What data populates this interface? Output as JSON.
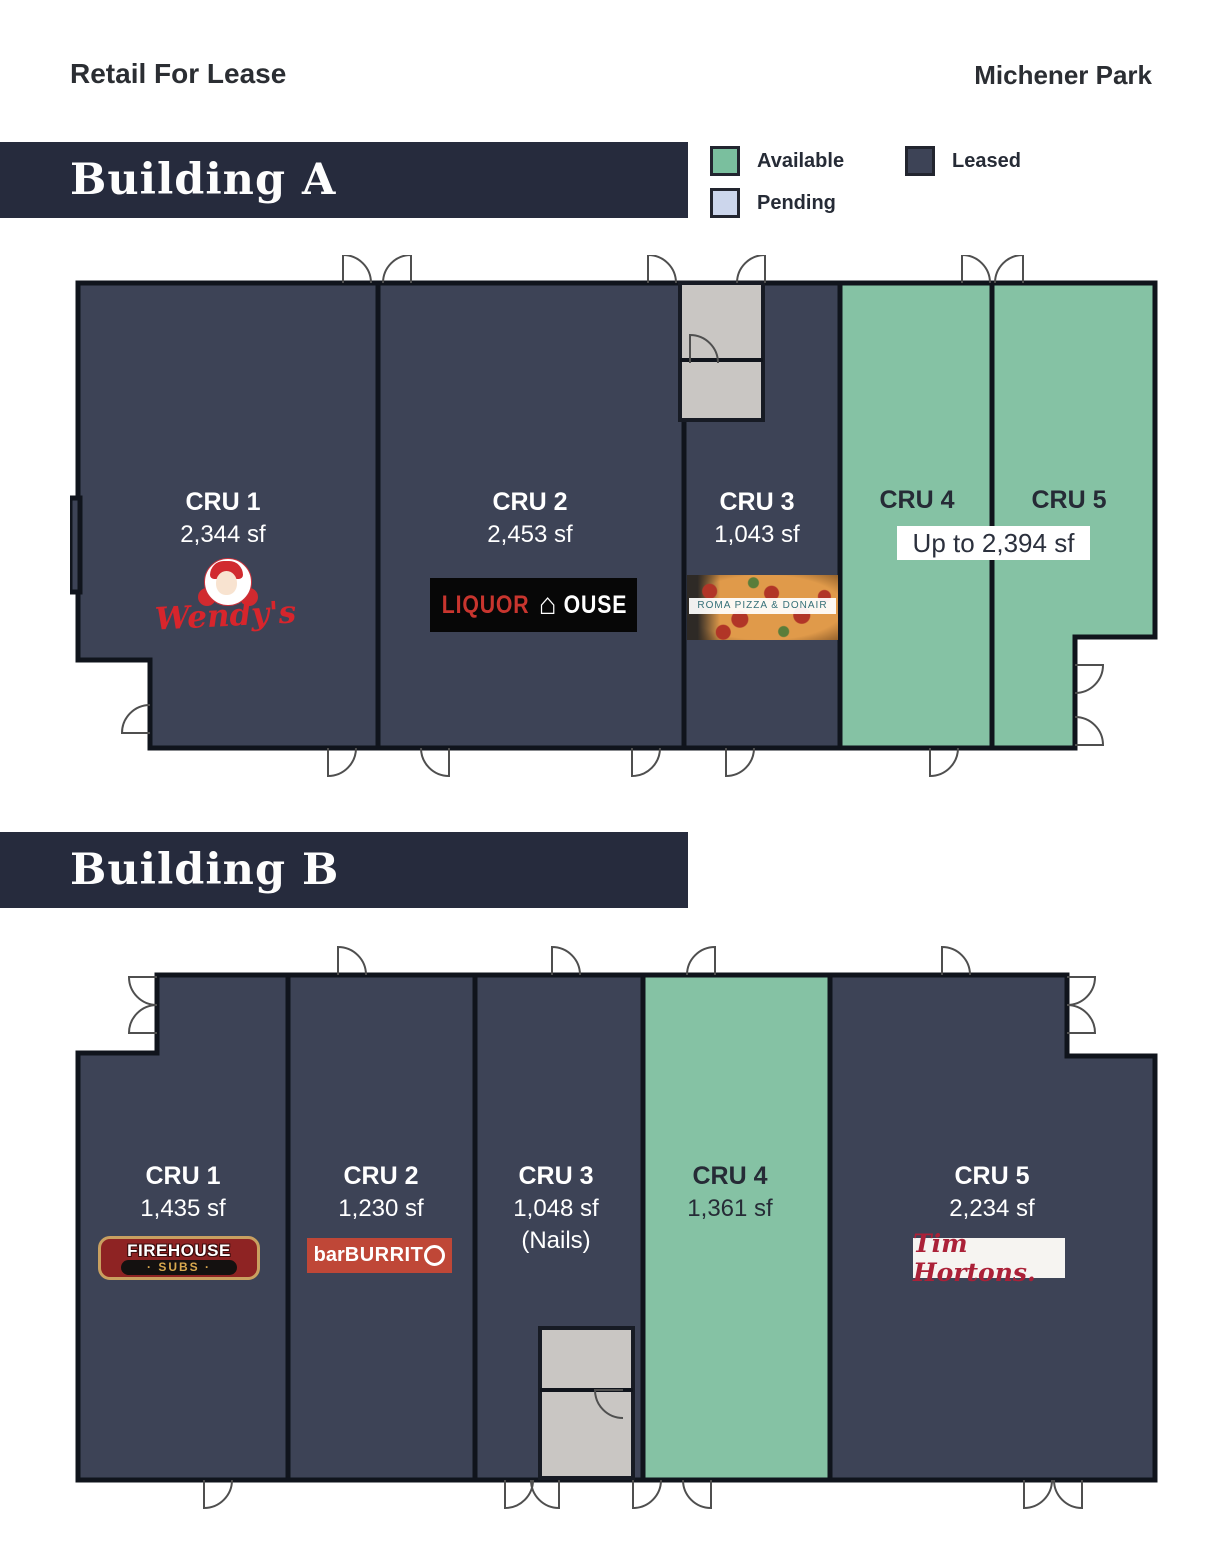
{
  "header": {
    "title_left": "Retail For Lease",
    "project": "Michener Park"
  },
  "legend": {
    "available": {
      "label": "Available",
      "color": "#7abf9e"
    },
    "pending": {
      "label": "Pending",
      "color": "#ccd6ec"
    },
    "leased": {
      "label": "Leased",
      "color": "#3d4356"
    }
  },
  "colors": {
    "banner": "#262b3d",
    "leased_fill": "#3d4356",
    "available_fill": "#85c2a4",
    "vestibule_gray": "#c9c6c3"
  },
  "buildings": {
    "a": {
      "name": "Building A",
      "combined_note": "Up to 2,394 sf",
      "units": [
        {
          "label": "CRU 1",
          "size": "2,344 sf",
          "status": "leased",
          "tenant": "Wendy's"
        },
        {
          "label": "CRU 2",
          "size": "2,453 sf",
          "status": "leased",
          "tenant": "Liquor House"
        },
        {
          "label": "CRU 3",
          "size": "1,043 sf",
          "status": "leased",
          "tenant": "Roma Pizza & Donair"
        },
        {
          "label": "CRU 4",
          "status": "available",
          "tenant": null
        },
        {
          "label": "CRU 5",
          "status": "available",
          "tenant": null
        }
      ]
    },
    "b": {
      "name": "Building B",
      "units": [
        {
          "label": "CRU 1",
          "size": "1,435 sf",
          "status": "leased",
          "tenant": "Firehouse Subs"
        },
        {
          "label": "CRU 2",
          "size": "1,230 sf",
          "status": "leased",
          "tenant": "barBURRITO"
        },
        {
          "label": "CRU 3",
          "size": "1,048 sf",
          "status": "leased",
          "tenant": "(Nails)",
          "note": "(Nails)"
        },
        {
          "label": "CRU 4",
          "size": "1,361 sf",
          "status": "available",
          "tenant": null
        },
        {
          "label": "CRU 5",
          "size": "2,234 sf",
          "status": "leased",
          "tenant": "Tim Hortons"
        }
      ]
    }
  },
  "logos": {
    "wendys": "Wendy's",
    "liquor": {
      "part1": "LIQUOR",
      "house_glyph": "⌂",
      "part2": "OUSE"
    },
    "roma": "ROMA PIZZA & DONAIR",
    "firehouse": {
      "line1": "FIREHOUSE",
      "line2": "· SUBS ·"
    },
    "barburrito": {
      "pre": "bar",
      "mid": "BURRIT",
      "end": "O"
    },
    "timhortons": "Tim Hortons."
  }
}
